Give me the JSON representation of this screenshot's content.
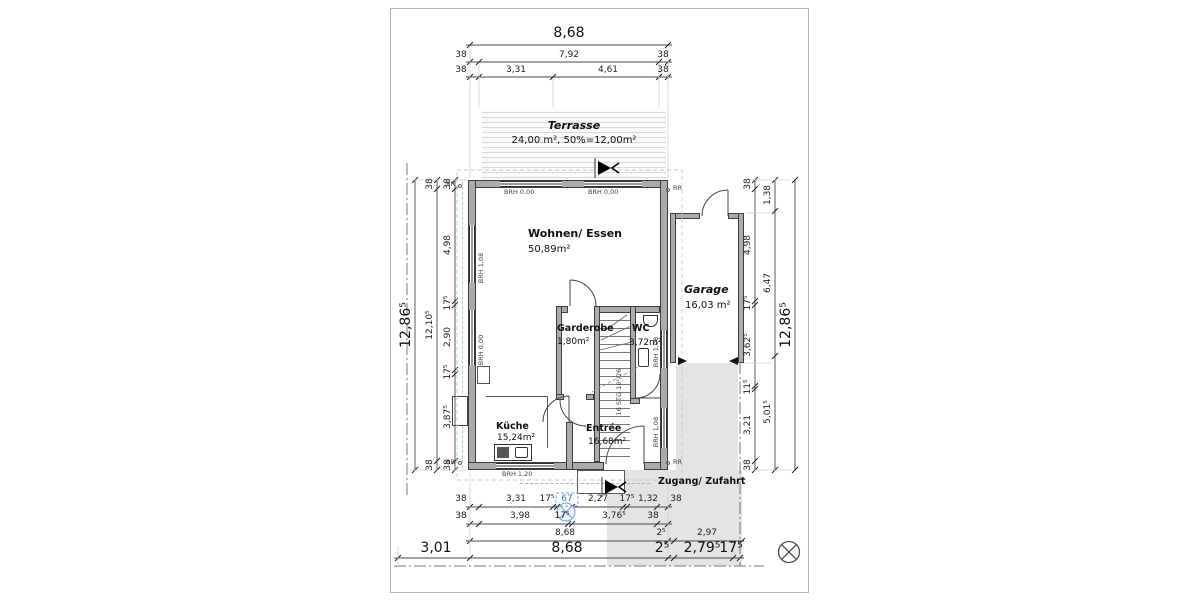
{
  "rooms": {
    "terrasse": {
      "name": "Terrasse",
      "area": "24,00 m², 50%=12,00m²"
    },
    "wohnen_essen": {
      "name": "Wohnen/ Essen",
      "area": "50,89m²"
    },
    "garage": {
      "name": "Garage",
      "area": "16,03 m²"
    },
    "garderobe": {
      "name": "Garderobe",
      "area": "1,80m²"
    },
    "wc": {
      "name": "WC",
      "area": "3,72m²"
    },
    "kueche": {
      "name": "Küche",
      "area": "15,24m²"
    },
    "entree": {
      "name": "Entrée",
      "area": "16,68m²"
    }
  },
  "labels": {
    "zugang": "Zugang/ Zufahrt",
    "stairs": "16 STG 18¹/26",
    "rr": "RR"
  },
  "window_sills": {
    "brh_000": "BRH 0,00",
    "brh_108": "BRH 1,08",
    "brh_120": "BRH 1,20"
  },
  "dimensions": {
    "top": {
      "total": "8,68",
      "row2": [
        "38",
        "7,92",
        "38"
      ],
      "row3": [
        "38",
        "3,31",
        "4,61",
        "38"
      ]
    },
    "left": {
      "total": "12,86⁵",
      "outer": [
        "38",
        "12,10⁵",
        "38"
      ],
      "inner": [
        "38",
        "4,98",
        "17⁵",
        "2,90",
        "17⁵",
        "3,87⁵",
        "38"
      ]
    },
    "right": {
      "total": "12,86⁵",
      "outer": [
        "1,38",
        "6,47",
        "5,01⁵"
      ],
      "inner": [
        "38",
        "4,98",
        "17⁵",
        "3,62⁵",
        "11⁵",
        "3,21",
        "38"
      ]
    },
    "bottom": {
      "row1": [
        "38",
        "3,31",
        "17⁵",
        "67",
        "2,27",
        "17⁵",
        "1,32",
        "38"
      ],
      "row2": [
        "38",
        "3,98",
        "17⁵",
        "3,76⁵",
        "38"
      ],
      "row3": [
        "8,68",
        "2⁵",
        "2,97"
      ],
      "row4": [
        "3,01",
        "8,68",
        "2⁵",
        "2,79⁵",
        "17⁵"
      ]
    }
  },
  "colors": {
    "wall": "#ababab",
    "wall_outline": "#3e3e3e",
    "driveway": "#e4e4e4",
    "terrace_hatch": "#d9d9d9",
    "dim_text": "#2b2b2b",
    "selection_blue": "#7b9fd4"
  }
}
